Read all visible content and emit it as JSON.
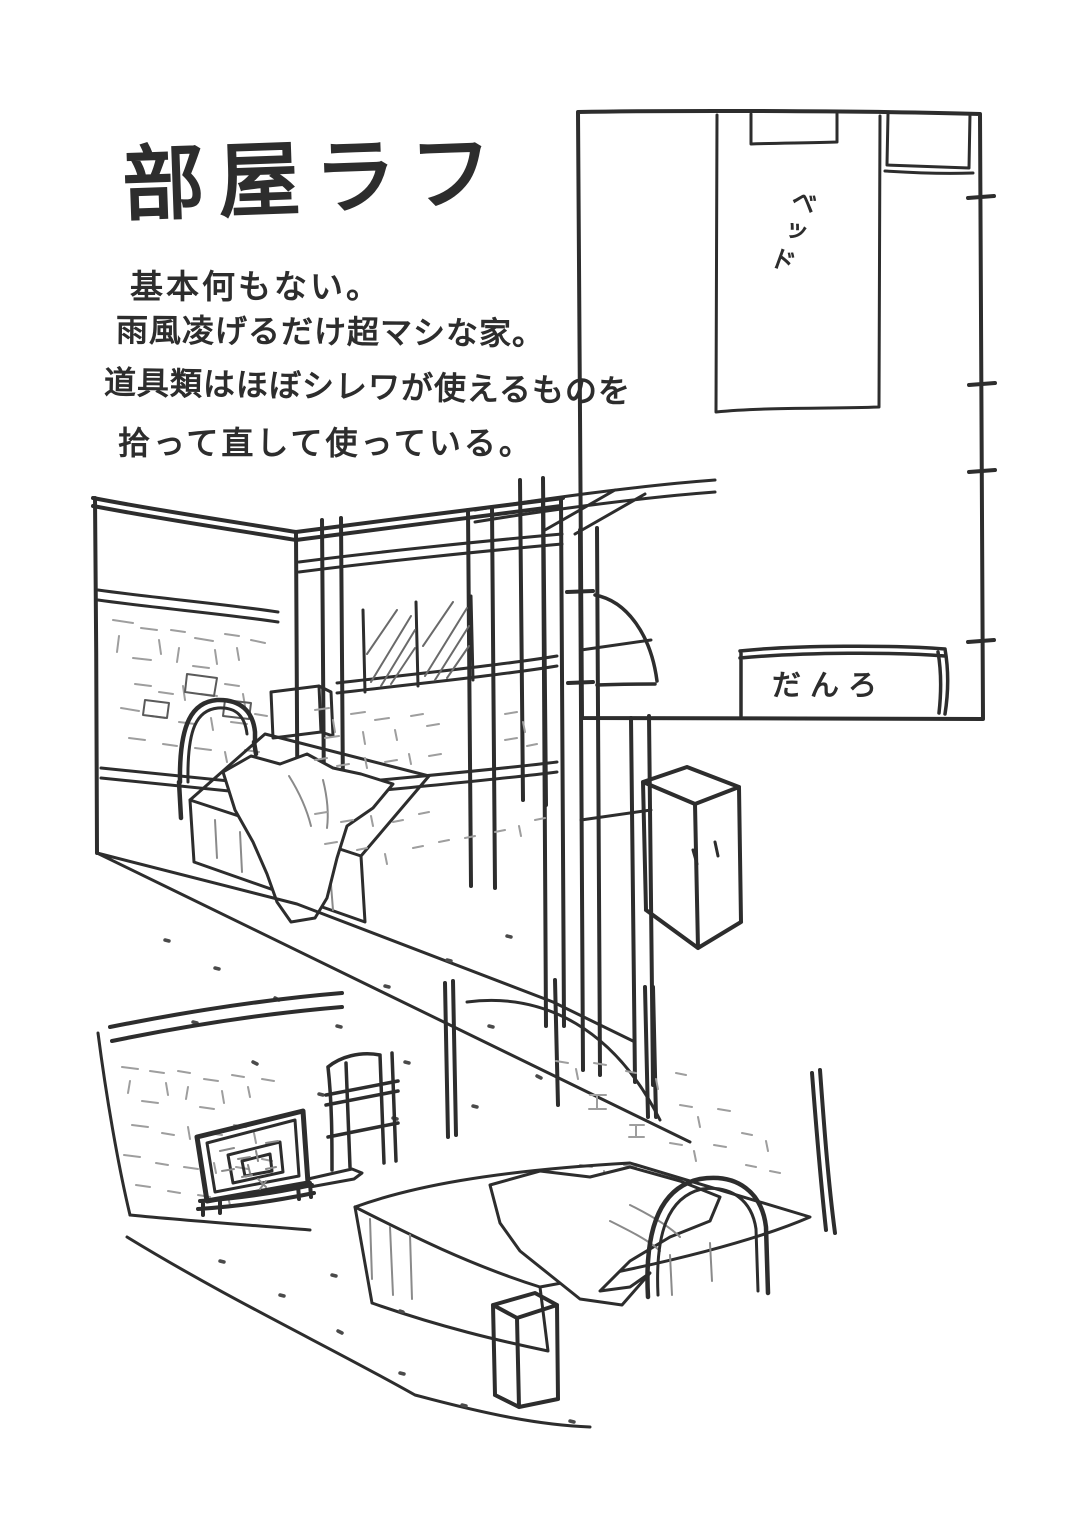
{
  "page": {
    "title": "部屋ラフ",
    "notes": {
      "line1": "基本何もない。",
      "line2": "雨風凌げるだけ超マシな家。",
      "line3": "道具類はほぼシレワが使えるものを",
      "line4": "拾って直して使っている。"
    }
  },
  "floorplan": {
    "bed_label": "ベッド",
    "fireplace_label": "だんろ"
  },
  "colors": {
    "paper": "#ffffff",
    "ink": "#2d2d2d",
    "ink_light": "#9e9e9e"
  }
}
